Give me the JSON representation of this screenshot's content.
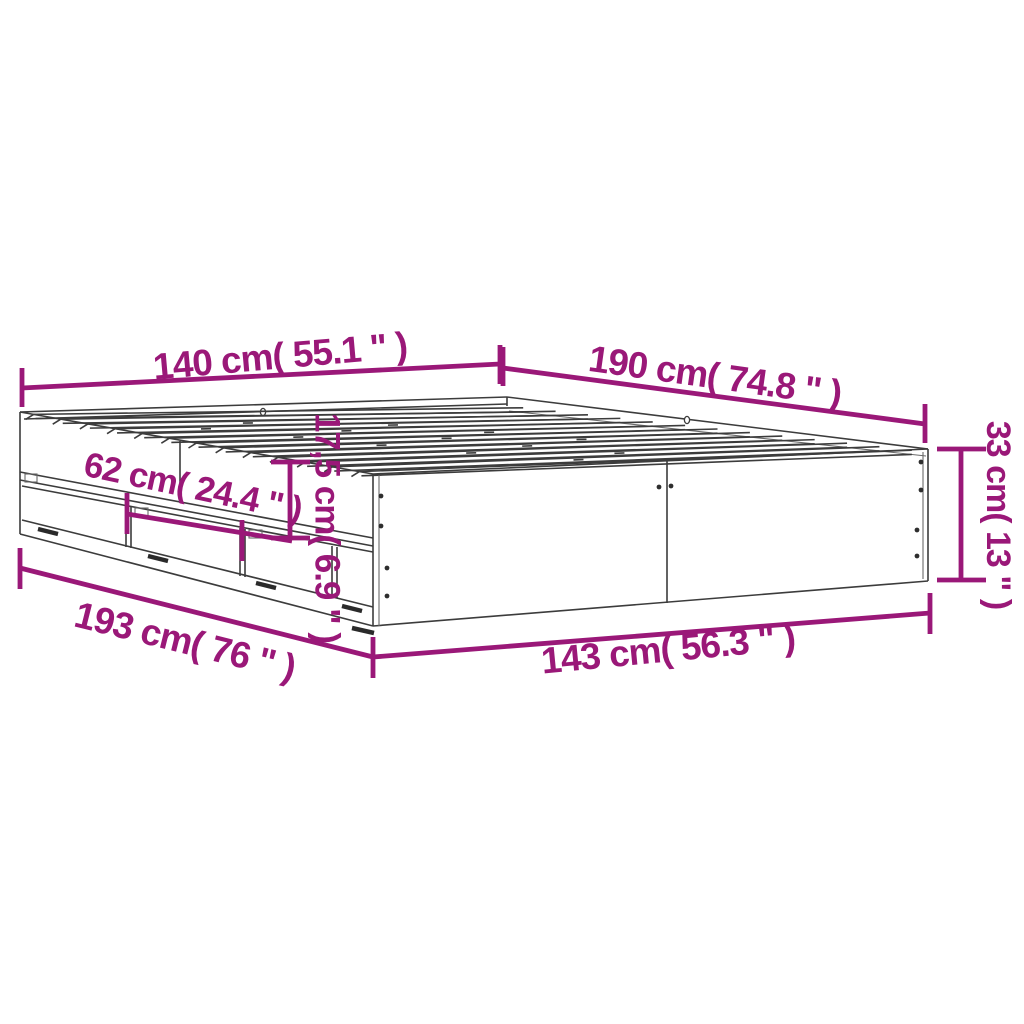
{
  "page": {
    "type": "product-dimension-diagram",
    "subject": "bed frame with storage drawers",
    "background": "#ffffff"
  },
  "colors": {
    "dimension_accent": "#9A1878",
    "drawing_ink": "#3C3C3C"
  },
  "dims": {
    "d140": {
      "label": "140 cm( 55.1 \" )"
    },
    "d190": {
      "label": "190 cm( 74.8 \" )"
    },
    "d33": {
      "label": "33 cm( 13 \" )"
    },
    "d62": {
      "label": "62 cm( 24.4 \" )"
    },
    "d175": {
      "label": "17,5 cm( 6.9 \" )"
    },
    "d193": {
      "label": "193 cm( 76 \" )"
    },
    "d143": {
      "label": "143 cm( 56.3 \" )"
    }
  }
}
